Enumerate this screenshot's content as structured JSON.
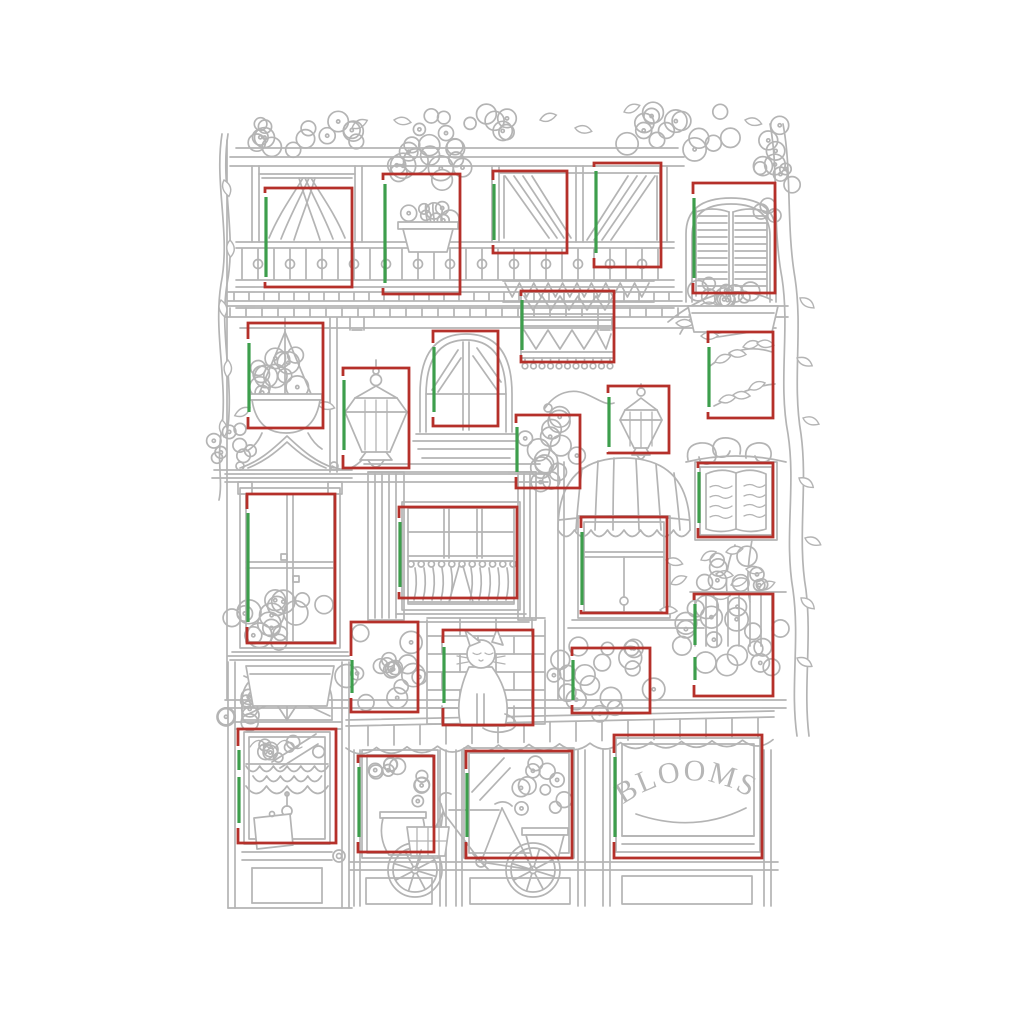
{
  "sign": {
    "text": "BLOOMS"
  },
  "palette": {
    "background": "#ffffff",
    "line_gray": "#b4b4b4",
    "annotation_red": "#b5302a",
    "annotation_green": "#3d9e4c"
  },
  "annotations": {
    "boxes": [
      {
        "name": "balcony-door-left",
        "x": 265,
        "y": 188,
        "w": 87,
        "h": 99,
        "gx": 266,
        "greens": [
          [
            197,
            277
          ]
        ]
      },
      {
        "name": "balcony-potted-tree",
        "x": 383,
        "y": 174,
        "w": 77,
        "h": 120,
        "gx": 385,
        "greens": [
          [
            184,
            283
          ]
        ]
      },
      {
        "name": "balcony-curtain-left",
        "x": 493,
        "y": 171,
        "w": 74,
        "h": 82,
        "gx": 494,
        "greens": [
          [
            184,
            240
          ]
        ]
      },
      {
        "name": "balcony-curtain-right",
        "x": 594,
        "y": 163,
        "w": 67,
        "h": 104,
        "gx": 596,
        "greens": [
          [
            171,
            253
          ]
        ]
      },
      {
        "name": "shuttered-window",
        "x": 693,
        "y": 183,
        "w": 82,
        "h": 110,
        "gx": 694,
        "greens": [
          [
            198,
            278
          ]
        ]
      },
      {
        "name": "hanging-flower-basket",
        "x": 248,
        "y": 323,
        "w": 75,
        "h": 105,
        "gx": 249,
        "greens": [
          [
            343,
            412
          ]
        ]
      },
      {
        "name": "wall-lantern-left",
        "x": 343,
        "y": 368,
        "w": 66,
        "h": 100,
        "gx": 344,
        "greens": [
          [
            380,
            450
          ]
        ]
      },
      {
        "name": "arched-window",
        "x": 433,
        "y": 331,
        "w": 65,
        "h": 95,
        "gx": 434,
        "greens": [
          [
            347,
            412
          ]
        ]
      },
      {
        "name": "hanging-rug",
        "x": 521,
        "y": 291,
        "w": 93,
        "h": 71,
        "gx": 522,
        "greens": [
          [
            300,
            350
          ]
        ]
      },
      {
        "name": "flower-bush",
        "x": 516,
        "y": 415,
        "w": 64,
        "h": 73,
        "gx": 517,
        "greens": [
          [
            427,
            472
          ]
        ]
      },
      {
        "name": "wall-lantern-right",
        "x": 608,
        "y": 386,
        "w": 61,
        "h": 67,
        "gx": 609,
        "greens": [
          [
            397,
            447
          ]
        ]
      },
      {
        "name": "tree-branches",
        "x": 708,
        "y": 332,
        "w": 65,
        "h": 86,
        "gx": 709,
        "greens": [
          [
            347,
            407
          ]
        ]
      },
      {
        "name": "open-book-window",
        "x": 698,
        "y": 463,
        "w": 75,
        "h": 74,
        "gx": 699,
        "greens": [
          [
            472,
            523
          ]
        ]
      },
      {
        "name": "four-pane-window",
        "x": 247,
        "y": 494,
        "w": 88,
        "h": 149,
        "gx": 248,
        "greens": [
          [
            513,
            622
          ]
        ]
      },
      {
        "name": "cafe-curtain-window",
        "x": 399,
        "y": 507,
        "w": 118,
        "h": 91,
        "gx": 400,
        "greens": [
          [
            522,
            587
          ]
        ]
      },
      {
        "name": "awning-shade-window",
        "x": 581,
        "y": 517,
        "w": 86,
        "h": 96,
        "gx": 582,
        "greens": [
          [
            532,
            605
          ]
        ]
      },
      {
        "name": "flower-box-left",
        "x": 351,
        "y": 622,
        "w": 67,
        "h": 90,
        "gx": 352,
        "greens": [
          [
            660,
            693
          ]
        ]
      },
      {
        "name": "cat-on-brick-wall",
        "x": 443,
        "y": 630,
        "w": 90,
        "h": 95,
        "gx": 444,
        "greens": [
          [
            647,
            703
          ]
        ]
      },
      {
        "name": "flower-box-middle",
        "x": 572,
        "y": 648,
        "w": 78,
        "h": 65,
        "gx": 573,
        "greens": [
          [
            660,
            700
          ]
        ]
      },
      {
        "name": "flower-box-right",
        "x": 694,
        "y": 594,
        "w": 79,
        "h": 102,
        "gx": 695,
        "greens": [
          [
            604,
            645
          ],
          [
            657,
            680
          ]
        ]
      },
      {
        "name": "shop-door-window",
        "x": 238,
        "y": 729,
        "w": 98,
        "h": 114,
        "gx": 239,
        "greens": [
          [
            750,
            770
          ],
          [
            777,
            823
          ]
        ]
      },
      {
        "name": "vase-window",
        "x": 358,
        "y": 756,
        "w": 76,
        "h": 96,
        "gx": 359,
        "greens": [
          [
            767,
            837
          ]
        ]
      },
      {
        "name": "bicycle-window",
        "x": 466,
        "y": 751,
        "w": 106,
        "h": 107,
        "gx": 467,
        "greens": [
          [
            773,
            837
          ]
        ]
      },
      {
        "name": "blooms-sign",
        "x": 614,
        "y": 735,
        "w": 148,
        "h": 123,
        "gx": 615,
        "greens": [
          [
            757,
            837
          ]
        ]
      }
    ]
  }
}
